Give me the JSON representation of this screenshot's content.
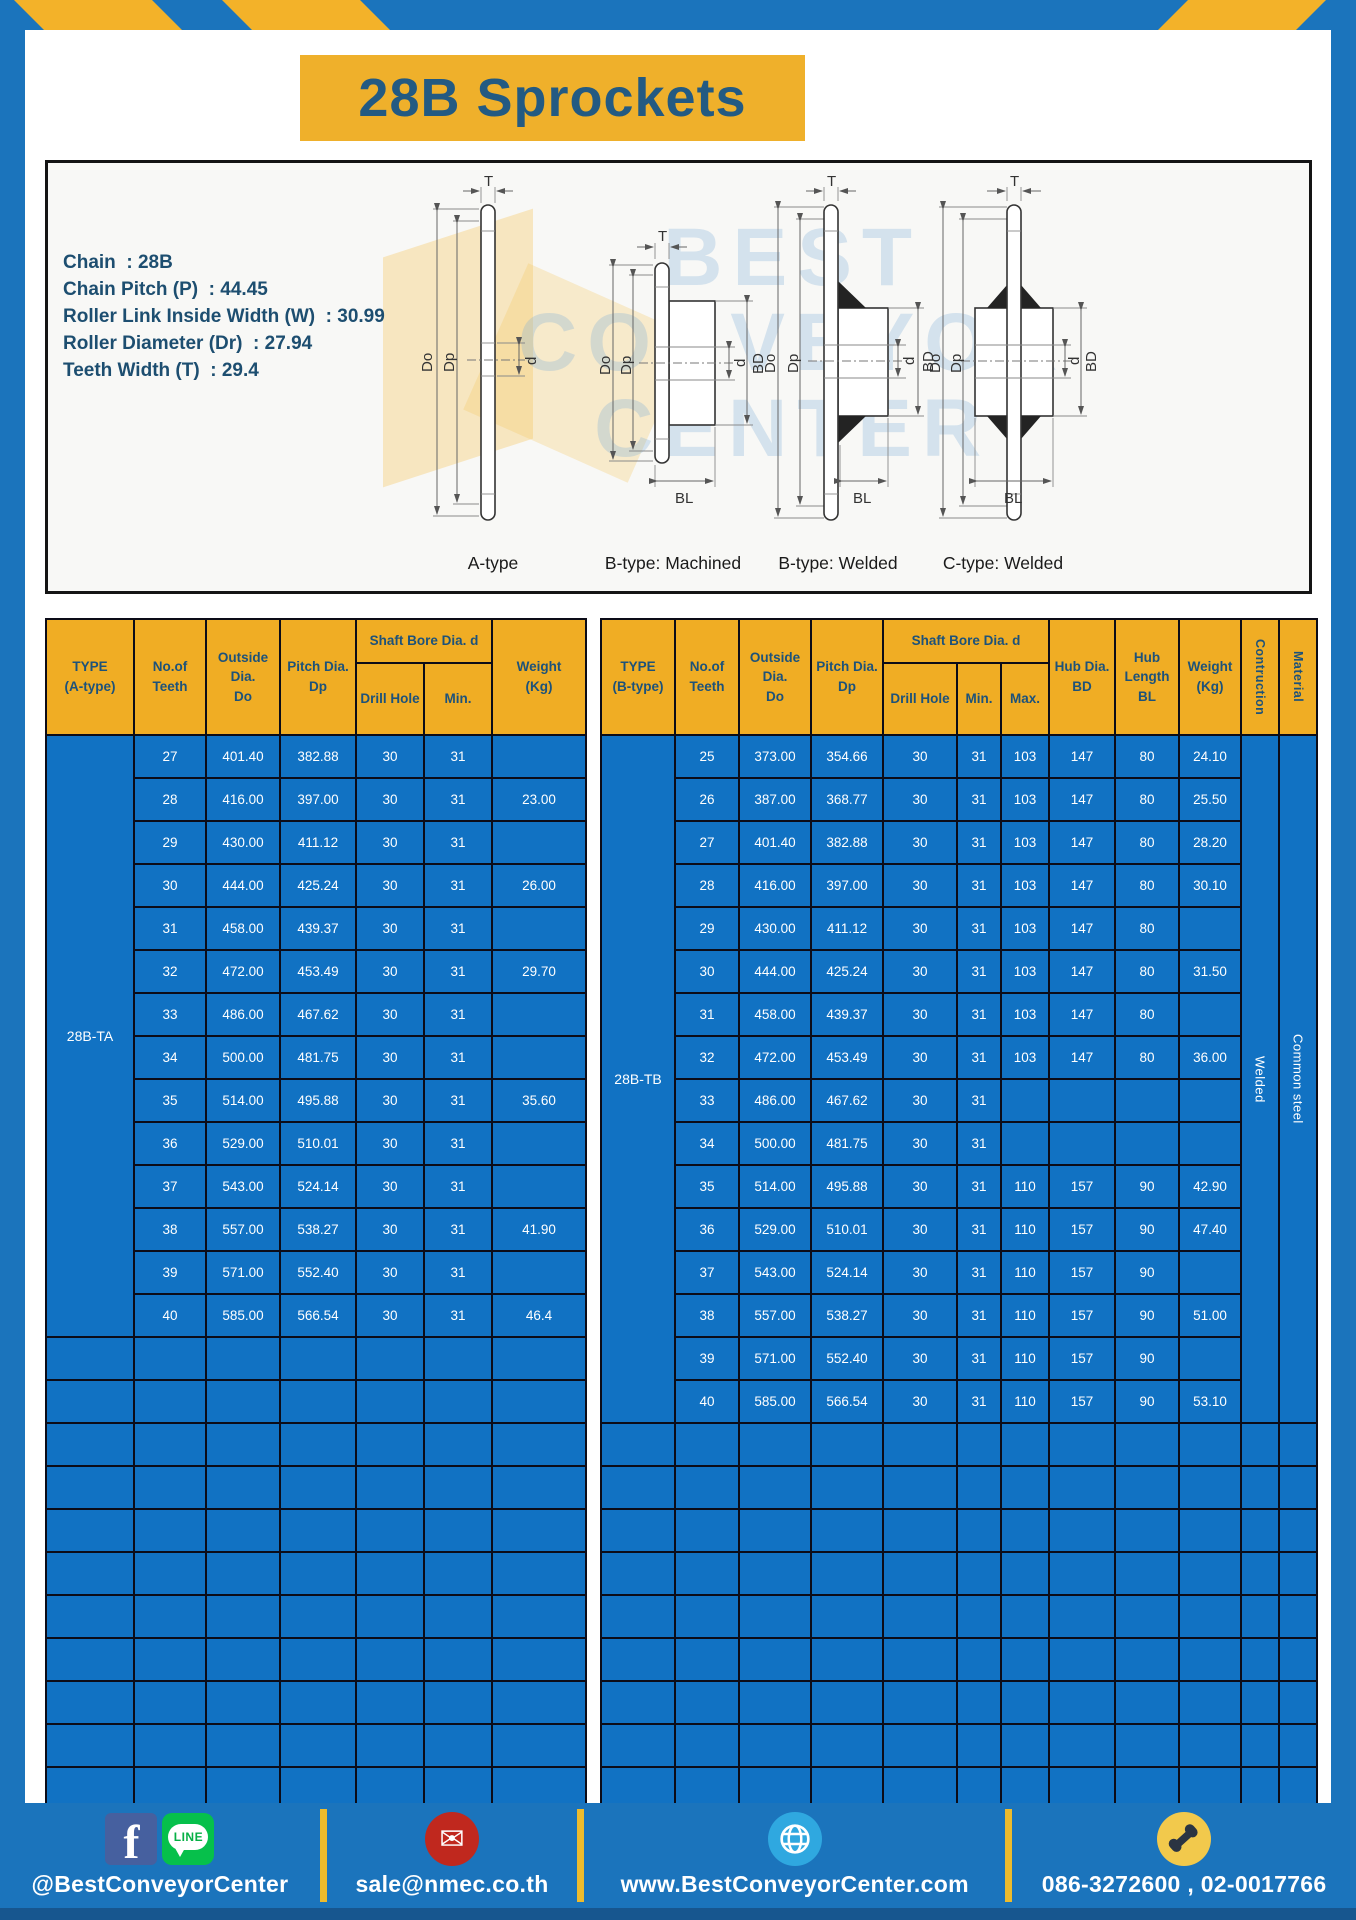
{
  "title": "28B Sprockets",
  "specs": [
    "Chain  : 28B",
    "Chain Pitch (P)  : 44.45",
    "Roller Link Inside Width (W)  : 30.99",
    "Roller Diameter (Dr)  : 27.94",
    "Teeth Width (T)  : 29.4"
  ],
  "diagram": {
    "watermark": "BEST\nCONVEYOR\nCENTER",
    "captions": [
      "A-type",
      "B-type: Machined",
      "B-type: Welded",
      "C-type: Welded"
    ],
    "dims": {
      "T": "T",
      "Do": "Do",
      "Dp": "Dp",
      "d": "d",
      "BD": "BD",
      "BL": "BL"
    }
  },
  "table_a": {
    "header": {
      "type": "TYPE\n(A-type)",
      "teeth": "No.of\nTeeth",
      "outside": "Outside\nDia.\nDo",
      "pitch": "Pitch Dia.\nDp",
      "shaft_bore": "Shaft Bore Dia. d",
      "drill": "Drill Hole",
      "min": "Min.",
      "weight": "Weight\n(Kg)"
    },
    "type_label": "28B-TA",
    "rows": [
      [
        "27",
        "401.40",
        "382.88",
        "30",
        "31",
        ""
      ],
      [
        "28",
        "416.00",
        "397.00",
        "30",
        "31",
        "23.00"
      ],
      [
        "29",
        "430.00",
        "411.12",
        "30",
        "31",
        ""
      ],
      [
        "30",
        "444.00",
        "425.24",
        "30",
        "31",
        "26.00"
      ],
      [
        "31",
        "458.00",
        "439.37",
        "30",
        "31",
        ""
      ],
      [
        "32",
        "472.00",
        "453.49",
        "30",
        "31",
        "29.70"
      ],
      [
        "33",
        "486.00",
        "467.62",
        "30",
        "31",
        ""
      ],
      [
        "34",
        "500.00",
        "481.75",
        "30",
        "31",
        ""
      ],
      [
        "35",
        "514.00",
        "495.88",
        "30",
        "31",
        "35.60"
      ],
      [
        "36",
        "529.00",
        "510.01",
        "30",
        "31",
        ""
      ],
      [
        "37",
        "543.00",
        "524.14",
        "30",
        "31",
        ""
      ],
      [
        "38",
        "557.00",
        "538.27",
        "30",
        "31",
        "41.90"
      ],
      [
        "39",
        "571.00",
        "552.40",
        "30",
        "31",
        ""
      ],
      [
        "40",
        "585.00",
        "566.54",
        "30",
        "31",
        "46.4"
      ]
    ],
    "empty_rows": 11
  },
  "table_b": {
    "header": {
      "type": "TYPE\n(B-type)",
      "teeth": "No.of\nTeeth",
      "outside": "Outside\nDia.\nDo",
      "pitch": "Pitch Dia.\nDp",
      "shaft_bore": "Shaft Bore Dia. d",
      "drill": "Drill Hole",
      "min": "Min.",
      "max": "Max.",
      "hub_dia": "Hub Dia.\nBD",
      "hub_len": "Hub\nLength\nBL",
      "weight": "Weight\n(Kg)",
      "construction": "Contruction",
      "material": "Material"
    },
    "type_label": "28B-TB",
    "construction": "Welded",
    "material": "Common steel",
    "rows": [
      [
        "25",
        "373.00",
        "354.66",
        "30",
        "31",
        "103",
        "147",
        "80",
        "24.10"
      ],
      [
        "26",
        "387.00",
        "368.77",
        "30",
        "31",
        "103",
        "147",
        "80",
        "25.50"
      ],
      [
        "27",
        "401.40",
        "382.88",
        "30",
        "31",
        "103",
        "147",
        "80",
        "28.20"
      ],
      [
        "28",
        "416.00",
        "397.00",
        "30",
        "31",
        "103",
        "147",
        "80",
        "30.10"
      ],
      [
        "29",
        "430.00",
        "411.12",
        "30",
        "31",
        "103",
        "147",
        "80",
        ""
      ],
      [
        "30",
        "444.00",
        "425.24",
        "30",
        "31",
        "103",
        "147",
        "80",
        "31.50"
      ],
      [
        "31",
        "458.00",
        "439.37",
        "30",
        "31",
        "103",
        "147",
        "80",
        ""
      ],
      [
        "32",
        "472.00",
        "453.49",
        "30",
        "31",
        "103",
        "147",
        "80",
        "36.00"
      ],
      [
        "33",
        "486.00",
        "467.62",
        "30",
        "31",
        "",
        "",
        "",
        ""
      ],
      [
        "34",
        "500.00",
        "481.75",
        "30",
        "31",
        "",
        "",
        "",
        ""
      ],
      [
        "35",
        "514.00",
        "495.88",
        "30",
        "31",
        "110",
        "157",
        "90",
        "42.90"
      ],
      [
        "36",
        "529.00",
        "510.01",
        "30",
        "31",
        "110",
        "157",
        "90",
        "47.40"
      ],
      [
        "37",
        "543.00",
        "524.14",
        "30",
        "31",
        "110",
        "157",
        "90",
        ""
      ],
      [
        "38",
        "557.00",
        "538.27",
        "30",
        "31",
        "110",
        "157",
        "90",
        "51.00"
      ],
      [
        "39",
        "571.00",
        "552.40",
        "30",
        "31",
        "110",
        "157",
        "90",
        ""
      ],
      [
        "40",
        "585.00",
        "566.54",
        "30",
        "31",
        "110",
        "157",
        "90",
        "53.10"
      ]
    ],
    "empty_rows": 9
  },
  "footer": {
    "facebook_glyph": "f",
    "line_glyph": "LINE",
    "email_glyph": "✉",
    "social_label": "@BestConveyorCenter",
    "email_label": "sale@nmec.co.th",
    "web_label": "www.BestConveyorCenter.com",
    "phone_label": "086-3272600 , 02-0017766"
  },
  "colors": {
    "page_blue": "#1b74bc",
    "cell_blue": "#1172c3",
    "accent_yellow": "#efb02b",
    "header_yellow": "#f0ad24",
    "header_text": "#1d527a"
  }
}
